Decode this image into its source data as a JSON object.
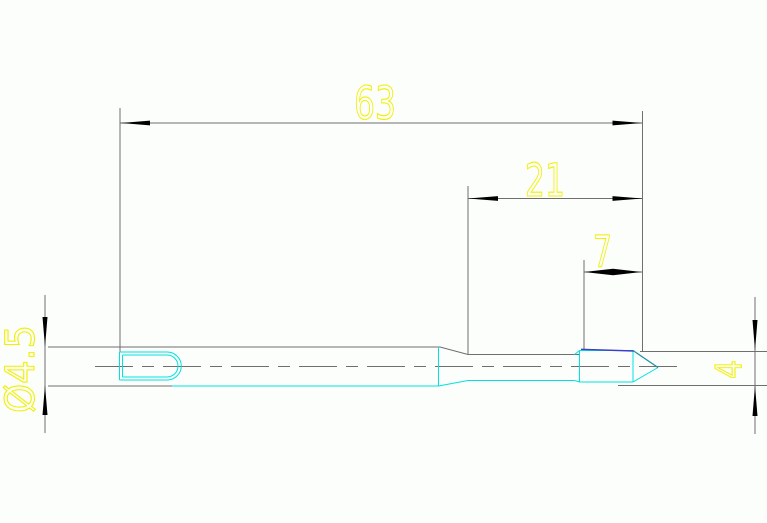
{
  "drawing": {
    "title": "pin-part-drawing",
    "dimensions": {
      "overall_length": "63",
      "front_section_length": "21",
      "tip_section_length": "7",
      "shank_diameter": "Ø4.5",
      "body_diameter": "4"
    },
    "colors": {
      "background": "#fcfefc",
      "outline": "#6f6f6f",
      "part": "#00e2e2",
      "accent_blue": "#3c3ccd",
      "cone_edge": "#1e8fa0",
      "dim_text": "#f0f000",
      "arrow": "#000000"
    }
  }
}
